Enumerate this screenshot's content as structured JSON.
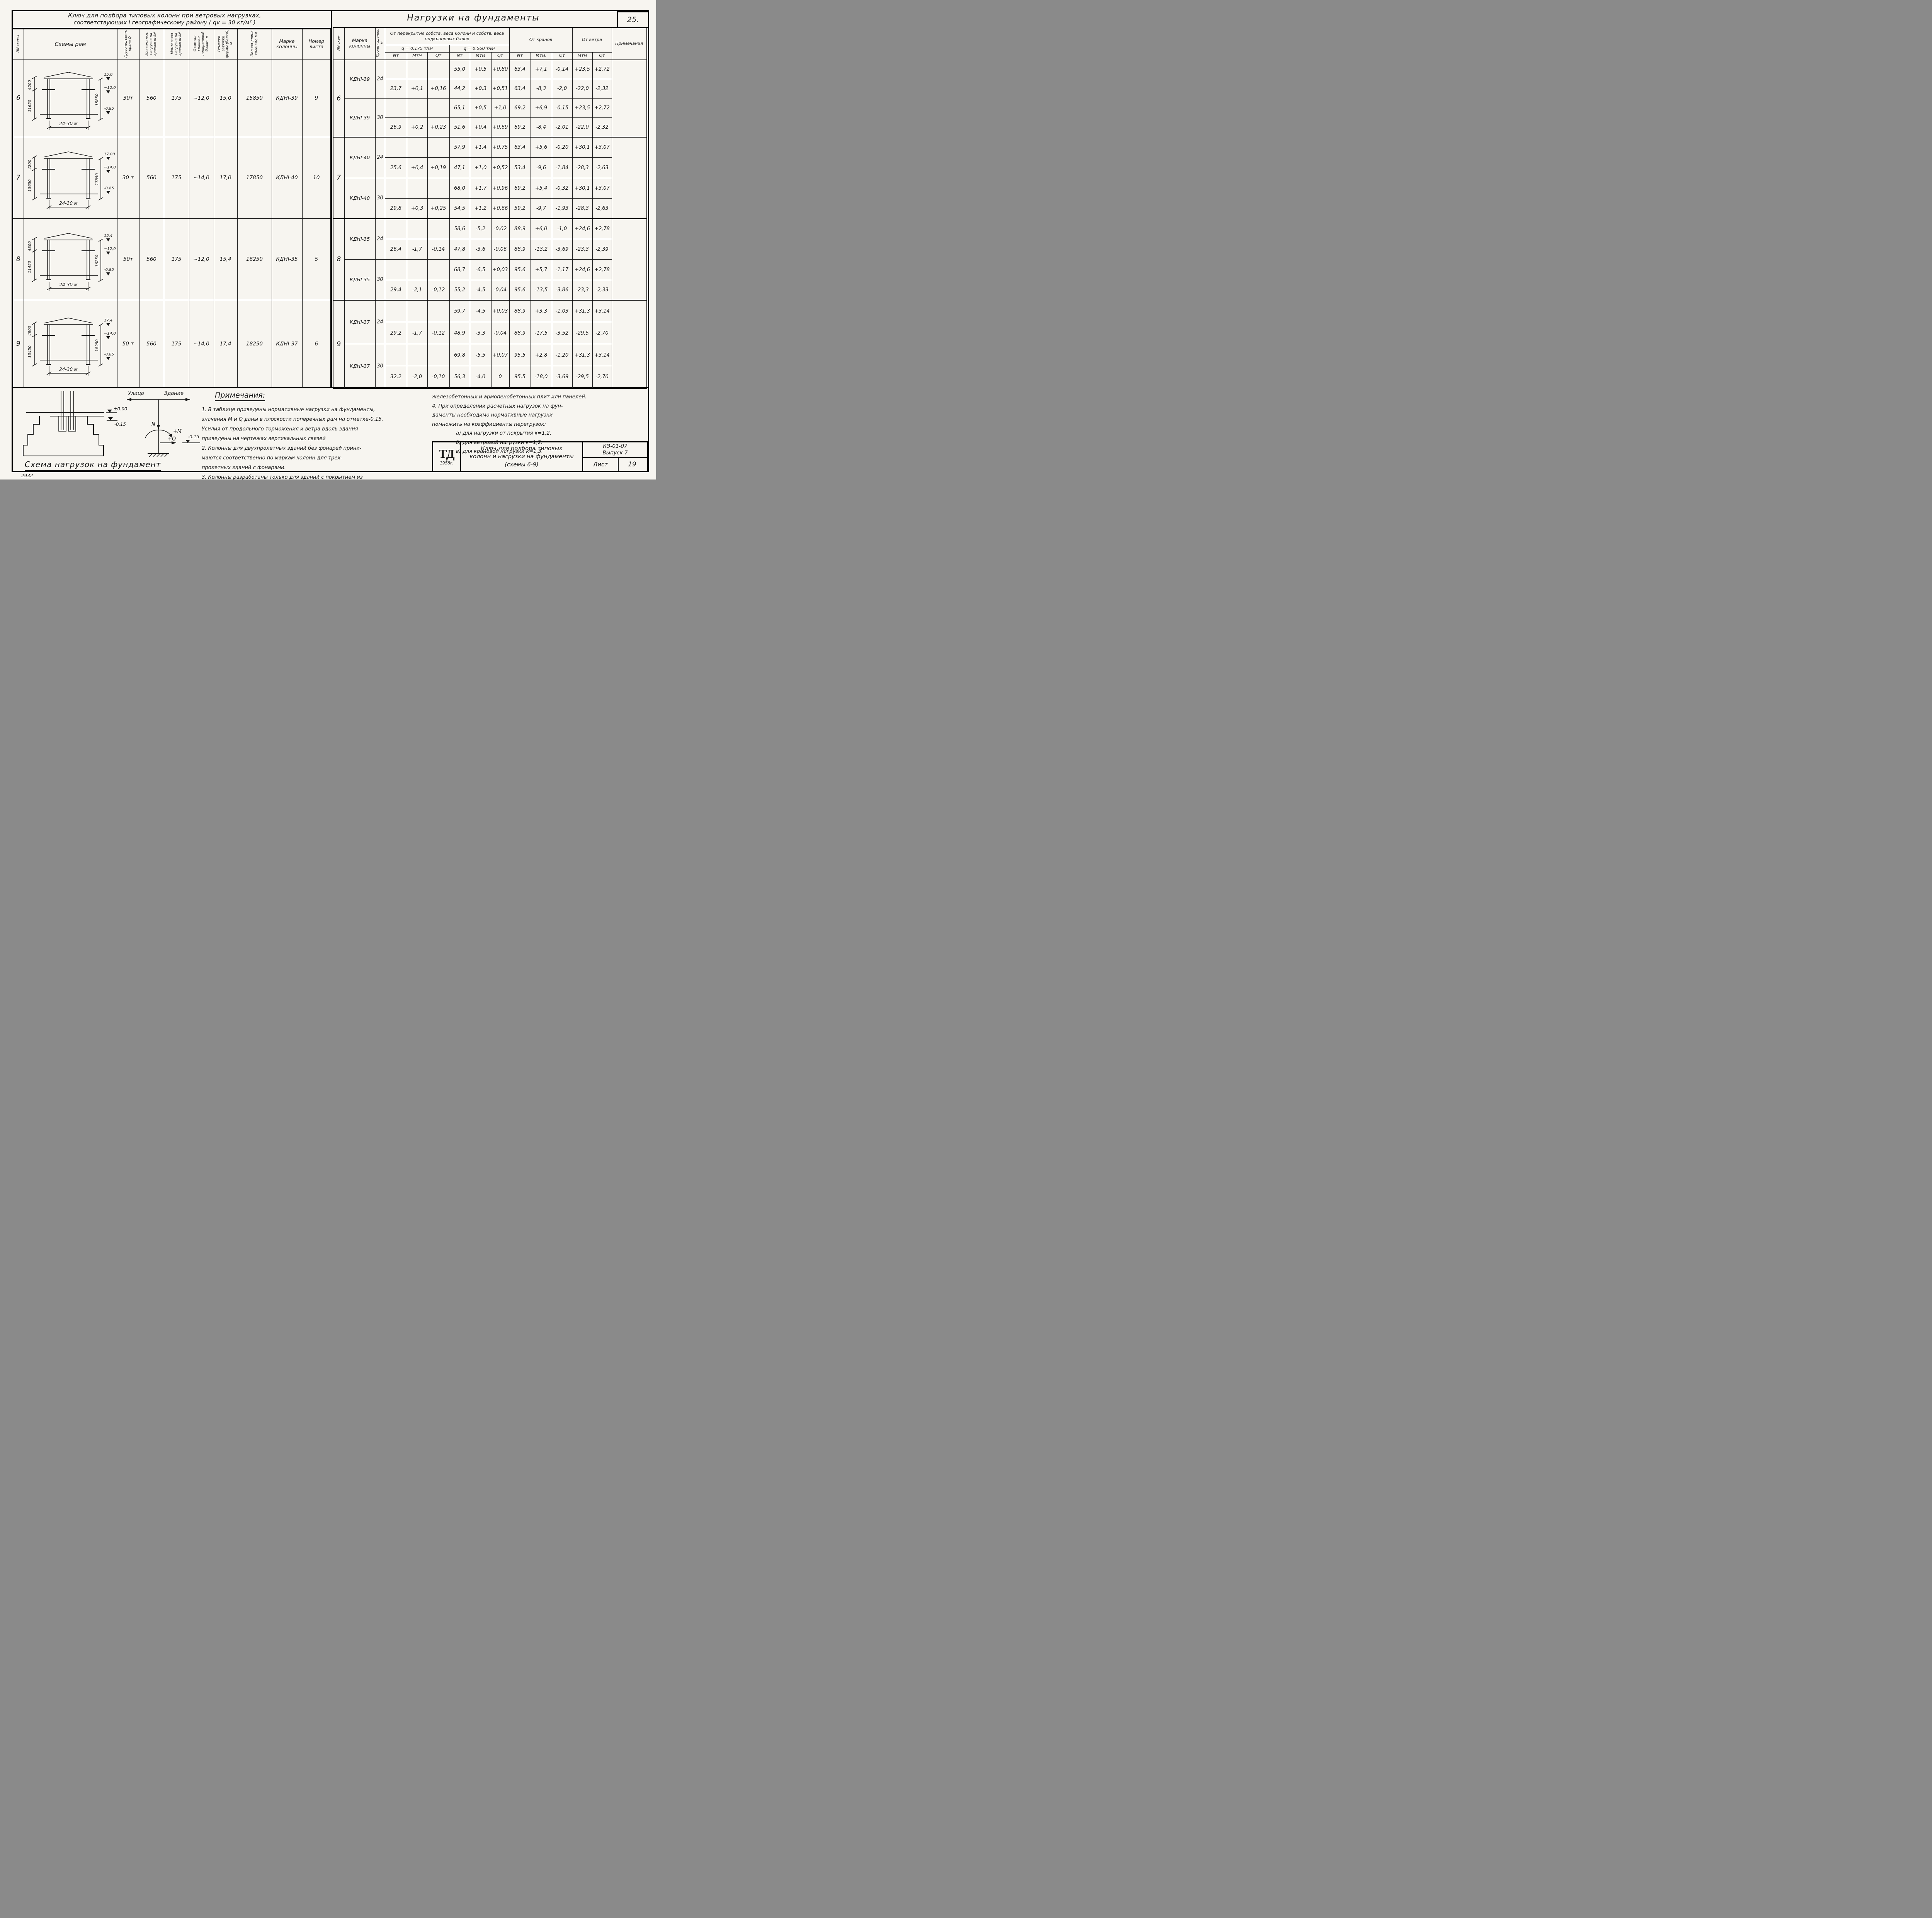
{
  "page": {
    "number": "25.",
    "stamp": "2932"
  },
  "left_table": {
    "title_line1": "Ключ для подбора типовых колонн при ветровых нагрузках,",
    "title_line2": "соответствующих I географическому району ( qv = 30 кг/м² )",
    "col_headers": [
      "NN схемы",
      "Схемы рам",
      "Грузоподъемн. крана Q",
      "Максимальн. нагрузка на кровлю кг/м²",
      "Монтажная нагрузка на кровлю кг/м²",
      "Отметка головки подкрановой балки, м",
      "Отметки затяжки фермы (балки), м",
      "Полная длина колонны, мм",
      "Марка колонны",
      "Номер листа"
    ],
    "rows": [
      {
        "scheme": "6",
        "diagram": {
          "dim_top_left": "4200",
          "dim_bottom_left": "11650",
          "dim_right": "15850",
          "elev_top": "15.0",
          "elev_mid": "~12.0",
          "elev_base": "-0.85",
          "span": "24-30 м"
        },
        "values": [
          "30т",
          "560",
          "175",
          "~12,0",
          "15,0",
          "15850",
          "КДНI-39",
          "9"
        ]
      },
      {
        "scheme": "7",
        "diagram": {
          "dim_top_left": "4200",
          "dim_bottom_left": "13650",
          "dim_right": "17850",
          "elev_top": "17.00",
          "elev_mid": "~14.0",
          "elev_base": "-0.85",
          "span": "24-30 м"
        },
        "values": [
          "30 т",
          "560",
          "175",
          "~14,0",
          "17,0",
          "17850",
          "КДНI-40",
          "10"
        ]
      },
      {
        "scheme": "8",
        "diagram": {
          "dim_top_left": "4800",
          "dim_bottom_left": "11450",
          "dim_right": "16250",
          "elev_top": "15,4",
          "elev_mid": "~12,0",
          "elev_base": "-0.85",
          "span": "24-30 м"
        },
        "values": [
          "50т",
          "560",
          "175",
          "~12,0",
          "15,4",
          "16250",
          "КДНI-35",
          "5"
        ]
      },
      {
        "scheme": "9",
        "diagram": {
          "dim_top_left": "4800",
          "dim_bottom_left": "13450",
          "dim_right": "18250",
          "elev_top": "17,4",
          "elev_mid": "~14,0",
          "elev_base": "-0.85",
          "span": "24-30 м"
        },
        "values": [
          "50 т",
          "560",
          "175",
          "~14,0",
          "17,4",
          "18250",
          "КДНI-37",
          "6"
        ]
      }
    ]
  },
  "right_table": {
    "title": "Нагрузки на фундаменты",
    "col_nn": "NN схем",
    "col_mark": "Марка колонны",
    "col_span": "Пролет здания, м",
    "group_header": "От перекрытия собств. веса колонн и собств. веса подкрановых балок",
    "q1": "q = 0.175 т/м²",
    "q2": "q = 0,560 т/м²",
    "cranes_header": "От кранов",
    "wind_header": "От ветра",
    "notes_header": "Примечания",
    "sub_headers": [
      "Nт",
      "Мтм",
      "Qт",
      "Nт",
      "Мтм",
      "Qт",
      "Nт",
      "Мтм.",
      "Qт",
      "Мтм",
      "Qт"
    ],
    "blocks": [
      {
        "scheme": "6",
        "groups": [
          {
            "mark": "КДНI-39",
            "span": "24",
            "rows": [
              [
                "",
                "",
                "",
                "55,0",
                "+0,5",
                "+0,80",
                "63,4",
                "+7,1",
                "-0,14",
                "+23,5",
                "+2,72"
              ],
              [
                "23,7",
                "+0,1",
                "+0,16",
                "44,2",
                "+0,3",
                "+0,51",
                "63,4",
                "-8,3",
                "-2,0",
                "-22,0",
                "-2,32"
              ]
            ]
          },
          {
            "mark": "КДНI-39",
            "span": "30",
            "rows": [
              [
                "",
                "",
                "",
                "65,1",
                "+0,5",
                "+1,0",
                "69,2",
                "+6,9",
                "-0,15",
                "+23,5",
                "+2,72"
              ],
              [
                "26,9",
                "+0,2",
                "+0,23",
                "51,6",
                "+0,4",
                "+0,69",
                "69,2",
                "-8,4",
                "-2,01",
                "-22,0",
                "-2,32"
              ]
            ]
          }
        ]
      },
      {
        "scheme": "7",
        "groups": [
          {
            "mark": "КДНI-40",
            "span": "24",
            "rows": [
              [
                "",
                "",
                "",
                "57,9",
                "+1,4",
                "+0,75",
                "63,4",
                "+5,6",
                "-0,20",
                "+30,1",
                "+3,07"
              ],
              [
                "25,6",
                "+0,4",
                "+0,19",
                "47,1",
                "+1,0",
                "+0,52",
                "53,4",
                "-9,6",
                "-1,84",
                "-28,3",
                "-2,63"
              ]
            ]
          },
          {
            "mark": "КДНI-40",
            "span": "30",
            "rows": [
              [
                "",
                "",
                "",
                "68,0",
                "+1,7",
                "+0,96",
                "69,2",
                "+5,4",
                "-0,32",
                "+30,1",
                "+3,07"
              ],
              [
                "29,8",
                "+0,3",
                "+0,25",
                "54,5",
                "+1,2",
                "+0,66",
                "59,2",
                "-9,7",
                "-1,93",
                "-28,3",
                "-2,63"
              ]
            ]
          }
        ]
      },
      {
        "scheme": "8",
        "groups": [
          {
            "mark": "КДНI-35",
            "span": "24",
            "rows": [
              [
                "",
                "",
                "",
                "58,6",
                "-5,2",
                "-0,02",
                "88,9",
                "+6,0",
                "-1,0",
                "+24,6",
                "+2,78"
              ],
              [
                "26,4",
                "-1,7",
                "-0,14",
                "47,8",
                "-3,6",
                "-0,06",
                "88,9",
                "-13,2",
                "-3,69",
                "-23,3",
                "-2,39"
              ]
            ]
          },
          {
            "mark": "КДНI-35",
            "span": "30",
            "rows": [
              [
                "",
                "",
                "",
                "68,7",
                "-6,5",
                "+0,03",
                "95,6",
                "+5,7",
                "-1,17",
                "+24,6",
                "+2,78"
              ],
              [
                "29,4",
                "-2,1",
                "-0,12",
                "55,2",
                "-4,5",
                "-0,04",
                "95,6",
                "-13,5",
                "-3,86",
                "-23,3",
                "-2,33"
              ]
            ]
          }
        ]
      },
      {
        "scheme": "9",
        "groups": [
          {
            "mark": "КДНI-37",
            "span": "24",
            "rows": [
              [
                "",
                "",
                "",
                "59,7",
                "-4,5",
                "+0,03",
                "88,9",
                "+3,3",
                "-1,03",
                "+31,3",
                "+3,14"
              ],
              [
                "29,2",
                "-1,7",
                "-0,12",
                "48,9",
                "-3,3",
                "-0,04",
                "88,9",
                "-17,5",
                "-3,52",
                "-29,5",
                "-2,70"
              ]
            ]
          },
          {
            "mark": "КДНI-37",
            "span": "30",
            "rows": [
              [
                "",
                "",
                "",
                "69,8",
                "-5,5",
                "+0,07",
                "95,5",
                "+2,8",
                "-1,20",
                "+31,3",
                "+3,14"
              ],
              [
                "32,2",
                "-2,0",
                "-0,10",
                "56,3",
                "-4,0",
                "0",
                "95,5",
                "-18,0",
                "-3,69",
                "-29,5",
                "-2,70"
              ]
            ]
          }
        ]
      }
    ]
  },
  "notes": {
    "heading": "Примечания:",
    "col1": [
      "1. В таблице приведены нормативные нагрузки на фундаменты,",
      "значения М и Q даны в плоскости поперечных рам на отметке-0,15.",
      "Усилия от продольного торможения и ветра вдоль здания",
      "приведены на чертежах вертикальных связей",
      "2. Колонны для двухпролетных зданий без фонарей прини-",
      "маются соответственно по маркам колонн для трех-",
      "пролетных зданий с фонарями.",
      "3. Колонны разработаны только для зданий с покрытием из"
    ],
    "col2": [
      "железобетонных и армопенобетонных плит или панелей.",
      "4. При определении расчетных нагрузок на фун-",
      "даменты необходимо нормативные нагрузки",
      "помножить на коэффициенты перегрузок:",
      "а) для нагрузки от покрытия к=1,2.",
      "б) для ветровой нагрузки к=1,2.",
      "в) для крановой нагрузки к=1,3."
    ]
  },
  "foundation": {
    "title": "Схема нагрузок на фундамент",
    "street": "Улица",
    "building": "Здание",
    "elev_zero": "±0.00",
    "elev_floor": "-0.15",
    "n_label": "N",
    "m_label": "+М",
    "q_label": "+Q",
    "elev_mark": "-0.15"
  },
  "title_block": {
    "logo": "ТД",
    "year": "1958г.",
    "line1": "Ключ для подбора типовых",
    "line2": "колонн и нагрузки на фундаменты",
    "line3": "(схемы 6-9)",
    "code": "КЭ-01-07",
    "issue": "Выпуск 7",
    "sheet_label": "Лист",
    "sheet_number": "19"
  }
}
